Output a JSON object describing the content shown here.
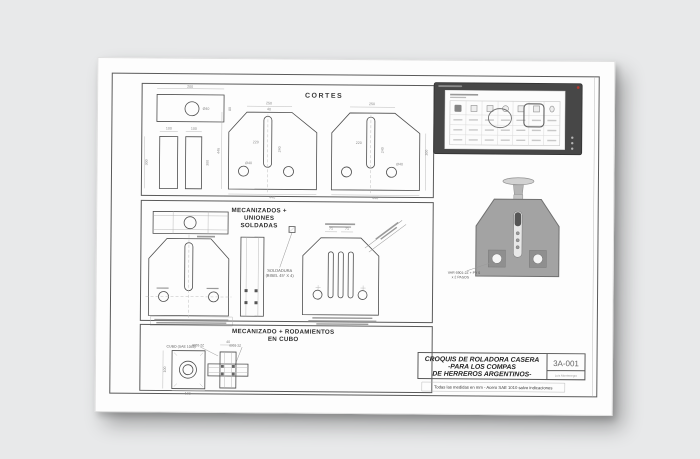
{
  "sheet": {
    "cortes_title": "CORTES",
    "mecanizados_title": [
      "MECANIZADOS +",
      "UNIONES",
      "SOLDADAS"
    ],
    "soldadura_label": [
      "SOLDADURA",
      "(BISEL 45° X 4)"
    ],
    "rodamientos_title": [
      "MECANIZADO + RODAMIENTOS",
      "EN CUBO"
    ],
    "cubo_label": "CUBO (SAE 1045)",
    "bearing_left": "6901-2Z",
    "bearing_right": "6901-2Z",
    "render_label": [
      "VAR 6901-2Z + PY 5",
      "x 2 PASOS"
    ],
    "title_block": {
      "line1": "CROQUIS DE ROLADORA CASERA",
      "line2": "-PARA LOS COMPAS",
      "line3": "DE HERREROS ARGENTINOS-",
      "code": "3A-001",
      "author": "Luis Montenegro",
      "note": "Todas las medidas en mm  -  Acero SAE 1010 salvo indicaciones"
    },
    "dims": [
      {
        "x": 92,
        "y": 29,
        "t": "200"
      },
      {
        "x": 133,
        "y": 50,
        "t": "80",
        "r": -90
      },
      {
        "x": 108,
        "y": 51,
        "t": "Ø40"
      },
      {
        "x": 71,
        "y": 71,
        "t": "100"
      },
      {
        "x": 96,
        "y": 71,
        "t": "100"
      },
      {
        "x": 50,
        "y": 104,
        "t": "300",
        "r": -90
      },
      {
        "x": 111,
        "y": 104,
        "t": "300",
        "r": -90
      },
      {
        "x": 171,
        "y": 45,
        "t": "250"
      },
      {
        "x": 122,
        "y": 92,
        "t": "446",
        "r": -90
      },
      {
        "x": 158,
        "y": 84,
        "t": "220"
      },
      {
        "x": 183,
        "y": 90,
        "t": "240",
        "r": -90
      },
      {
        "x": 151,
        "y": 105,
        "t": "Ø40"
      },
      {
        "x": 175,
        "y": 139,
        "t": "440"
      },
      {
        "x": 171,
        "y": 51,
        "t": "40"
      },
      {
        "x": 274,
        "y": 45,
        "t": "250"
      },
      {
        "x": 330,
        "y": 92,
        "t": "300",
        "r": -90
      },
      {
        "x": 261,
        "y": 84,
        "t": "220"
      },
      {
        "x": 286,
        "y": 90,
        "t": "240",
        "r": -90
      },
      {
        "x": 302,
        "y": 105,
        "t": "Ø40"
      },
      {
        "x": 278,
        "y": 139,
        "t": "440"
      },
      {
        "x": 70,
        "y": 311,
        "t": "100",
        "r": -90
      },
      {
        "x": 92,
        "y": 336,
        "t": "100"
      },
      {
        "x": 132,
        "y": 284,
        "t": "40"
      },
      {
        "x": 234,
        "y": 170,
        "t": "71"
      },
      {
        "x": 250,
        "y": 170,
        "t": "71"
      }
    ]
  },
  "colors": {
    "plate_fill": "#a3a3a3",
    "window_frame": "#474747",
    "close_red": "#b3392f"
  }
}
